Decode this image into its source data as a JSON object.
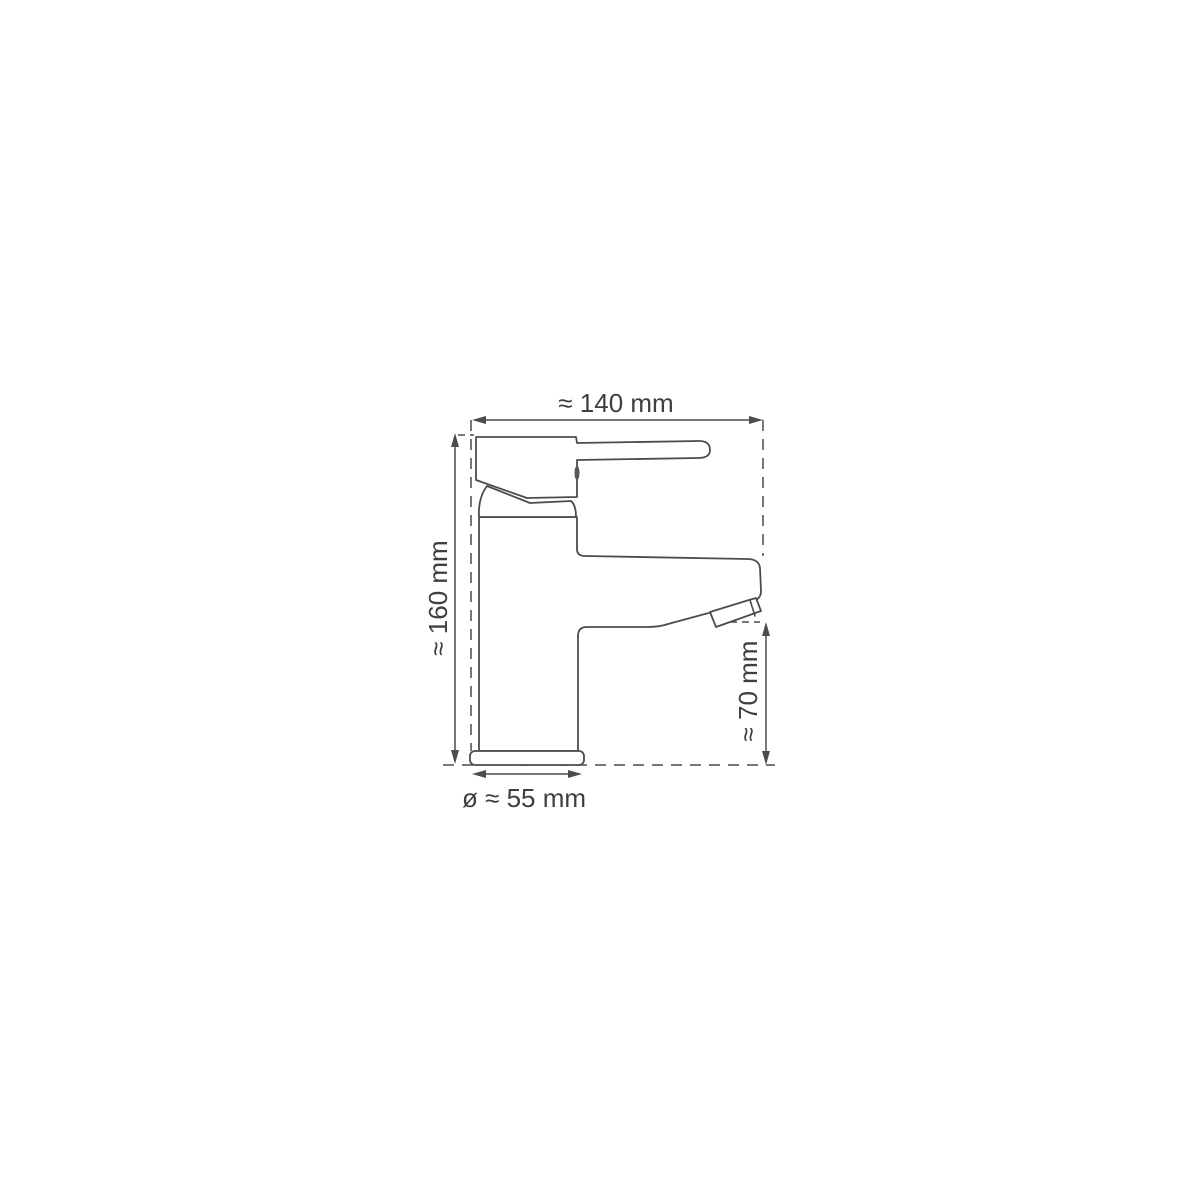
{
  "drawing": {
    "kind": "technical dimension drawing",
    "subject": "single-lever basin mixer tap, side view",
    "background_color": "#ffffff",
    "line_color": "#4a4c4f",
    "text_color": "#3d4043",
    "dimensions": {
      "overall_width": {
        "label": "≈ 140 mm",
        "value_mm": 140,
        "approx": true
      },
      "overall_height": {
        "label": "≈ 160 mm",
        "value_mm": 160,
        "approx": true
      },
      "spout_height": {
        "label": "≈ 70 mm",
        "value_mm": 70,
        "approx": true
      },
      "base_diameter": {
        "label": "ø ≈ 55 mm",
        "value_mm": 55,
        "approx": true,
        "is_diameter": true
      }
    }
  }
}
